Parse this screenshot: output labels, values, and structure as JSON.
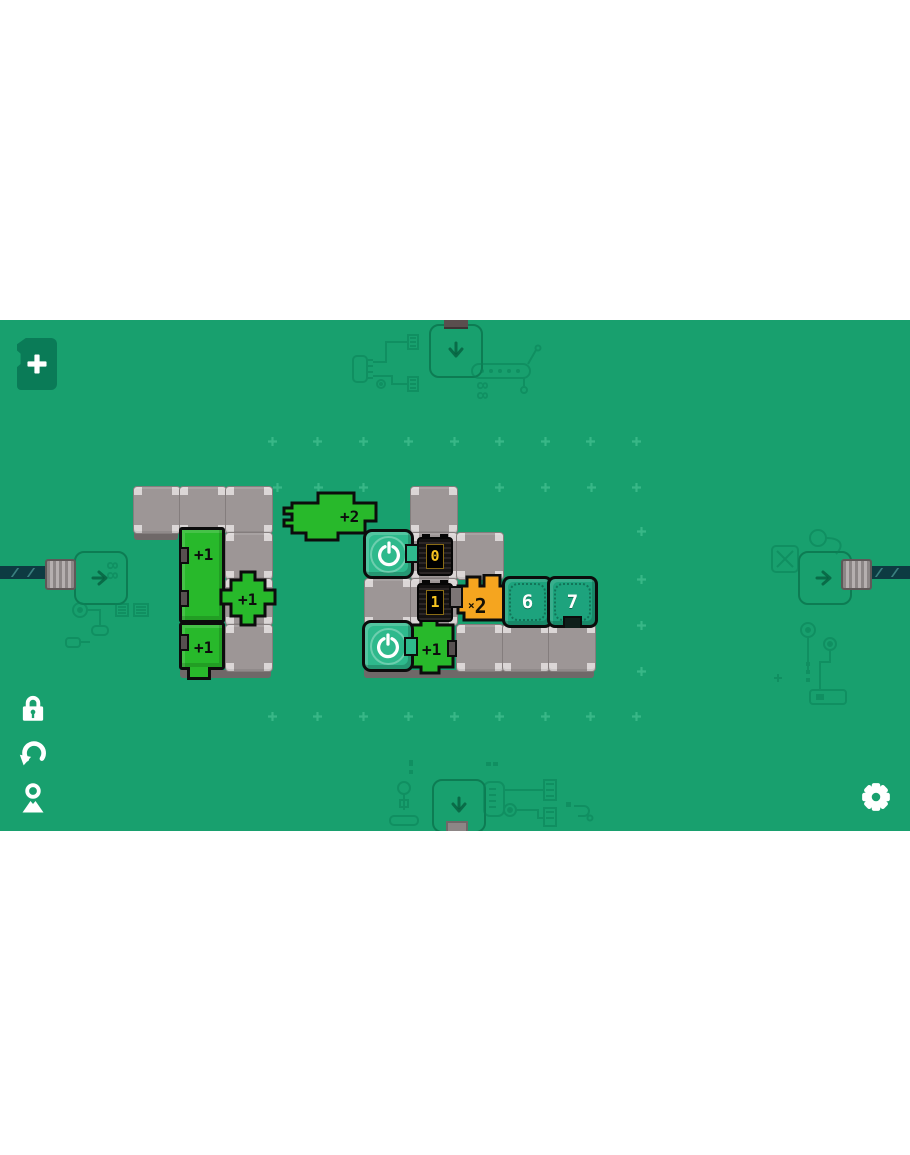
{
  "colors": {
    "background_green": "#18A06E",
    "piece_green": "#28B92B",
    "power_teal": "#2EB98C",
    "number_tile_teal": "#1DA37D",
    "multiplier_orange": "#F5A51F",
    "counter_digit_yellow": "#F7C41F",
    "tile_gray": "#9D9696",
    "card_teal": "#0A7B57"
  },
  "hud": {
    "add_label": "+",
    "lock": "lock",
    "undo": "undo",
    "pin": "location",
    "gear": "settings"
  },
  "decor": {
    "display_top": "88",
    "display_left": "88"
  },
  "board": {
    "gray_tiles": [
      [
        133,
        166
      ],
      [
        179,
        166
      ],
      [
        225,
        166
      ],
      [
        225,
        212
      ],
      [
        225,
        258
      ],
      [
        225,
        304
      ],
      [
        410,
        166
      ],
      [
        410,
        212
      ],
      [
        456,
        212
      ],
      [
        364,
        258
      ],
      [
        410,
        258
      ],
      [
        456,
        304
      ],
      [
        502,
        304
      ],
      [
        548,
        304
      ]
    ],
    "shadows": [
      [
        134,
        212,
        44
      ],
      [
        180,
        350,
        91
      ],
      [
        364,
        350,
        230
      ]
    ],
    "pieces": [
      {
        "id": "piece-plus1-tall",
        "label": "+1"
      },
      {
        "id": "piece-plus1-cross",
        "label": "+1"
      },
      {
        "id": "piece-plus1-foot",
        "label": "+1"
      },
      {
        "id": "piece-plus2-wide",
        "label": "+2"
      },
      {
        "id": "piece-plus1-mid",
        "label": "+1"
      }
    ],
    "multiplier": {
      "symbol": "×",
      "digit": "2"
    },
    "counters": [
      {
        "value": "0"
      },
      {
        "value": "1"
      }
    ],
    "number_tiles": [
      {
        "label": "6"
      },
      {
        "label": "7"
      }
    ]
  },
  "sparkles": [
    [
      268,
      117
    ],
    [
      313,
      117
    ],
    [
      359,
      117
    ],
    [
      404,
      117
    ],
    [
      450,
      117
    ],
    [
      495,
      117
    ],
    [
      541,
      117
    ],
    [
      586,
      117
    ],
    [
      632,
      117
    ],
    [
      273,
      163
    ],
    [
      314,
      163
    ],
    [
      359,
      163
    ],
    [
      495,
      163
    ],
    [
      541,
      163
    ],
    [
      587,
      163
    ],
    [
      632,
      163
    ],
    [
      637,
      207
    ],
    [
      637,
      255
    ],
    [
      637,
      301
    ],
    [
      637,
      347
    ],
    [
      268,
      392
    ],
    [
      313,
      392
    ],
    [
      359,
      392
    ],
    [
      404,
      392
    ],
    [
      450,
      392
    ],
    [
      495,
      392
    ],
    [
      541,
      392
    ],
    [
      586,
      392
    ],
    [
      632,
      392
    ]
  ]
}
